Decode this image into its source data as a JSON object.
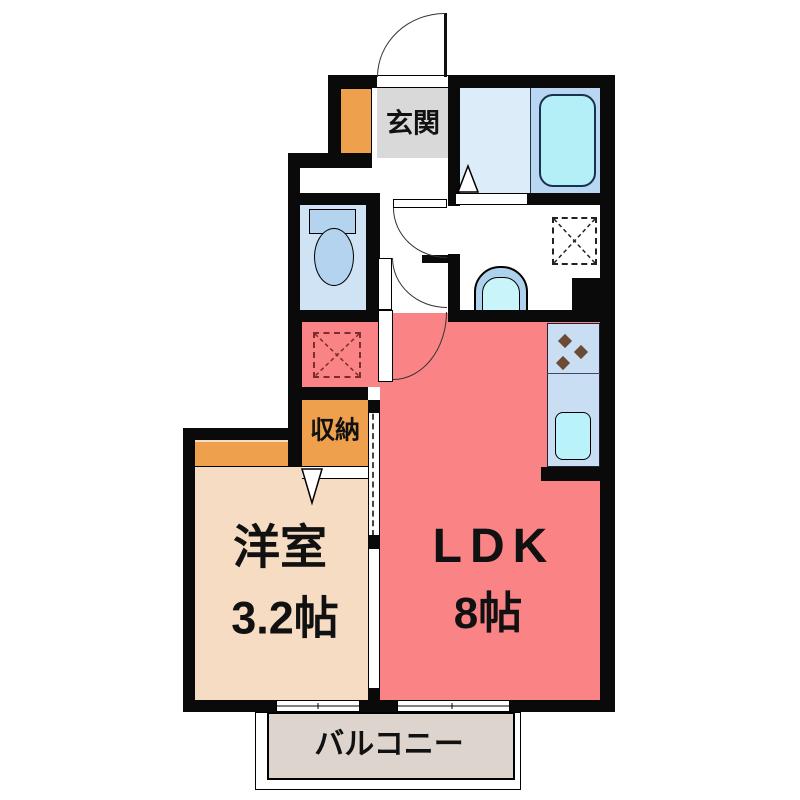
{
  "plan_title": "1LDK apartment floor plan",
  "rooms": {
    "entrance": {
      "label": "玄関"
    },
    "storage": {
      "label": "収納"
    },
    "western_room": {
      "label": "洋室",
      "size": "3.2帖"
    },
    "ldk": {
      "label": "LDK",
      "size": "8帖"
    },
    "balcony": {
      "label": "バルコニー"
    }
  },
  "colors": {
    "wall": "#0a0a0a",
    "entrance_floor": "#d9d9d9",
    "cabinet_orange": "#efa04d",
    "bath_floor": "#dcecf8",
    "tub_pad": "#b9d7f2",
    "tub_fill": "#b4eef6",
    "toilet_floor": "#cfe3f5",
    "fixture_blue": "#b3d3ef",
    "sink_outer": "#aed2ee",
    "sink_inner": "#c8f4fa",
    "kitchen_counter": "#c9def2",
    "kitchen_sink": "#b9f2f8",
    "burner": "#6b4a36",
    "ldk_floor": "#fa8385",
    "room_floor": "#f6dcc2",
    "balcony_floor": "#ddd5cd",
    "pan_dash_ldk": "#7b2d2d",
    "pan_dash_wash": "#222222",
    "door_line": "#333333",
    "text": "#111111"
  }
}
